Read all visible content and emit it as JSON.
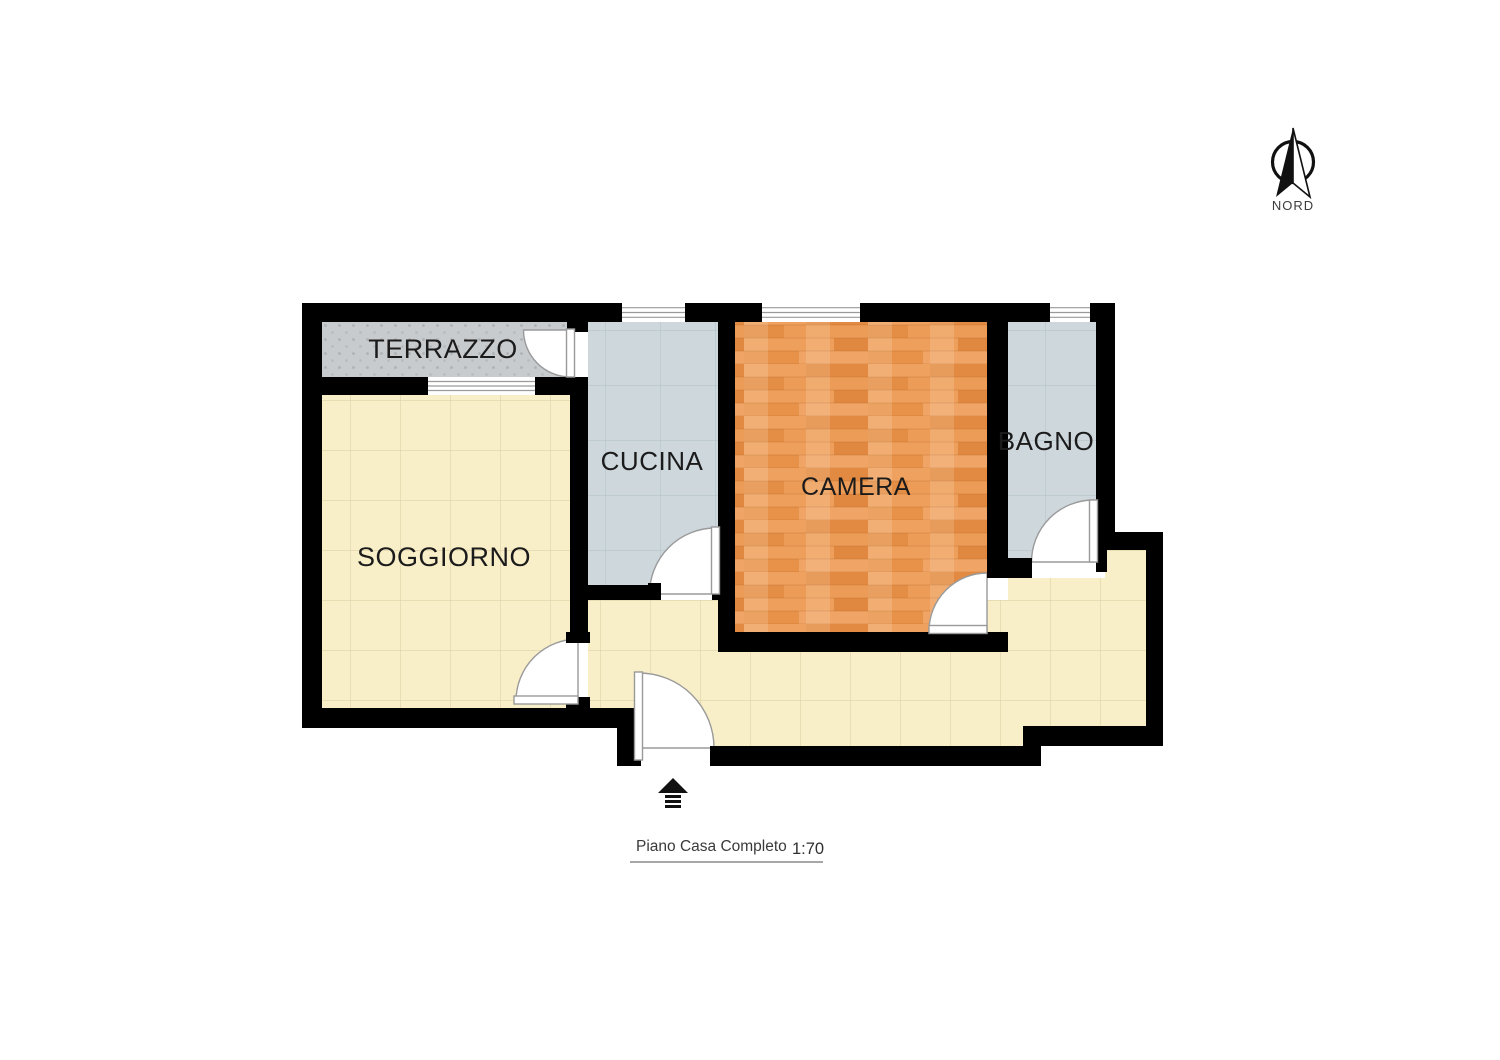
{
  "plan": {
    "type": "floor-plan",
    "wall_color": "#000000",
    "background": "#ffffff"
  },
  "compass": {
    "label": "NORD"
  },
  "rooms": [
    {
      "id": "terrazzo",
      "label": "TERRAZZO",
      "floor": "gray-dotted",
      "floor_color": "#c7cbce"
    },
    {
      "id": "soggiorno",
      "label": "SOGGIORNO",
      "floor": "yellow-tile",
      "floor_color": "#f8eec7"
    },
    {
      "id": "cucina",
      "label": "CUCINA",
      "floor": "blue-tile",
      "floor_color": "#cdd7dc"
    },
    {
      "id": "camera",
      "label": "CAMERA",
      "floor": "wood-planks",
      "floor_color": "#e9954f"
    },
    {
      "id": "bagno",
      "label": "BAGNO",
      "floor": "blue-tile",
      "floor_color": "#cdd7dc"
    }
  ],
  "hallway": {
    "floor": "yellow-tile",
    "floor_color": "#f8eec7"
  },
  "footer": {
    "title": "Piano Casa Completo",
    "scale": "1:70"
  }
}
